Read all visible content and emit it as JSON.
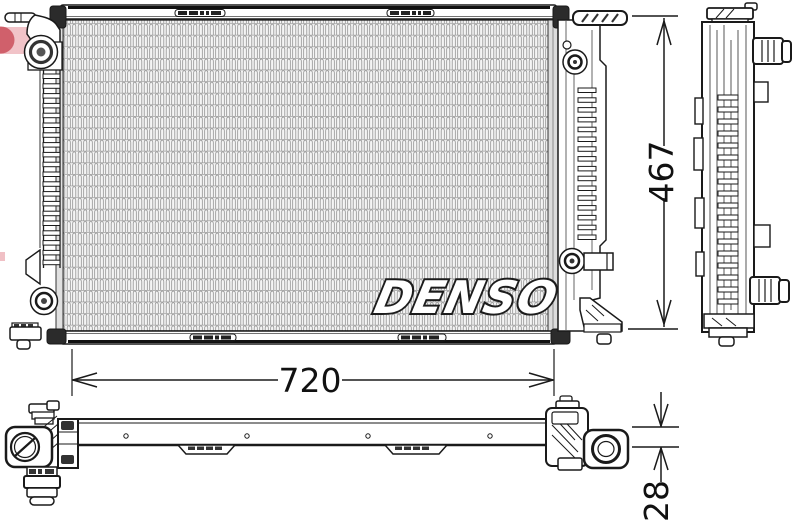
{
  "watermark": {
    "brand": "DENSO",
    "logo_red": "#c43a47",
    "logo_pink": "#d9626e"
  },
  "dimensions": {
    "width": "720",
    "height": "467",
    "depth": "28"
  },
  "colors": {
    "line": "#1a1a1a",
    "paper": "#ffffff",
    "core_texture": "#8d8d8d",
    "dark_fill": "#2b2b2b"
  }
}
